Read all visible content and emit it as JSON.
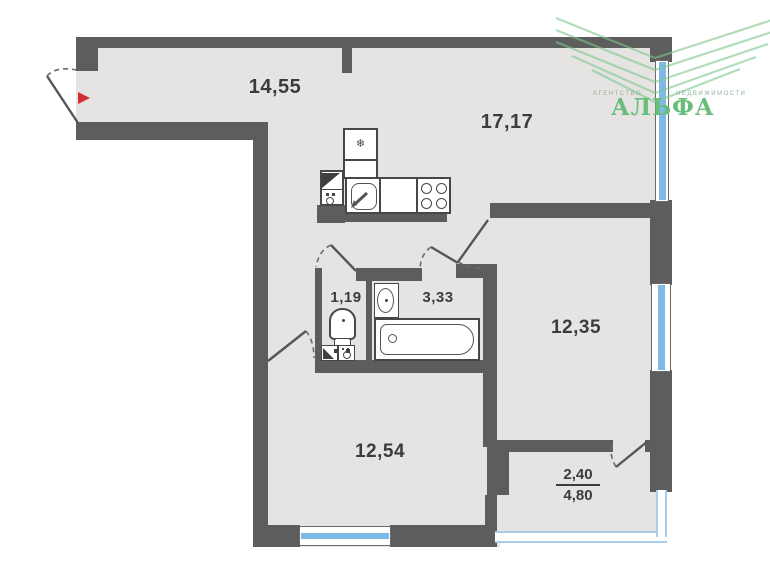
{
  "plan": {
    "rooms": [
      {
        "id": "hallway",
        "area_label": "14,55"
      },
      {
        "id": "kitchen-living",
        "area_label": "17,17"
      },
      {
        "id": "wc",
        "area_label": "1,19"
      },
      {
        "id": "bathroom",
        "area_label": "3,33"
      },
      {
        "id": "room-right",
        "area_label": "12,35"
      },
      {
        "id": "room-bottom",
        "area_label": "12,54"
      },
      {
        "id": "balcony",
        "area_label_top": "2,40",
        "area_label_bottom": "4,80"
      }
    ],
    "fixtures": [
      "fridge",
      "kitchen-sink",
      "stove",
      "washing-machine",
      "toilet",
      "corner-sink",
      "washbasin",
      "bathtub"
    ]
  },
  "glyphs": {
    "snowflake": "❄"
  },
  "logo": {
    "word_left": "АГЕНТСТВО",
    "word_right": "НЕДВИЖИМОСТИ",
    "brand": "АЛЬФА"
  },
  "colors": {
    "wall": "#5d5d5d",
    "floor": "#e5e4e2",
    "window_blue": "#7fb9e6",
    "glazing_blue": "#a9cdec",
    "entrance_red": "#d03030",
    "logo_green": "#69bd7b",
    "label_dark": "#3c3c3c"
  }
}
